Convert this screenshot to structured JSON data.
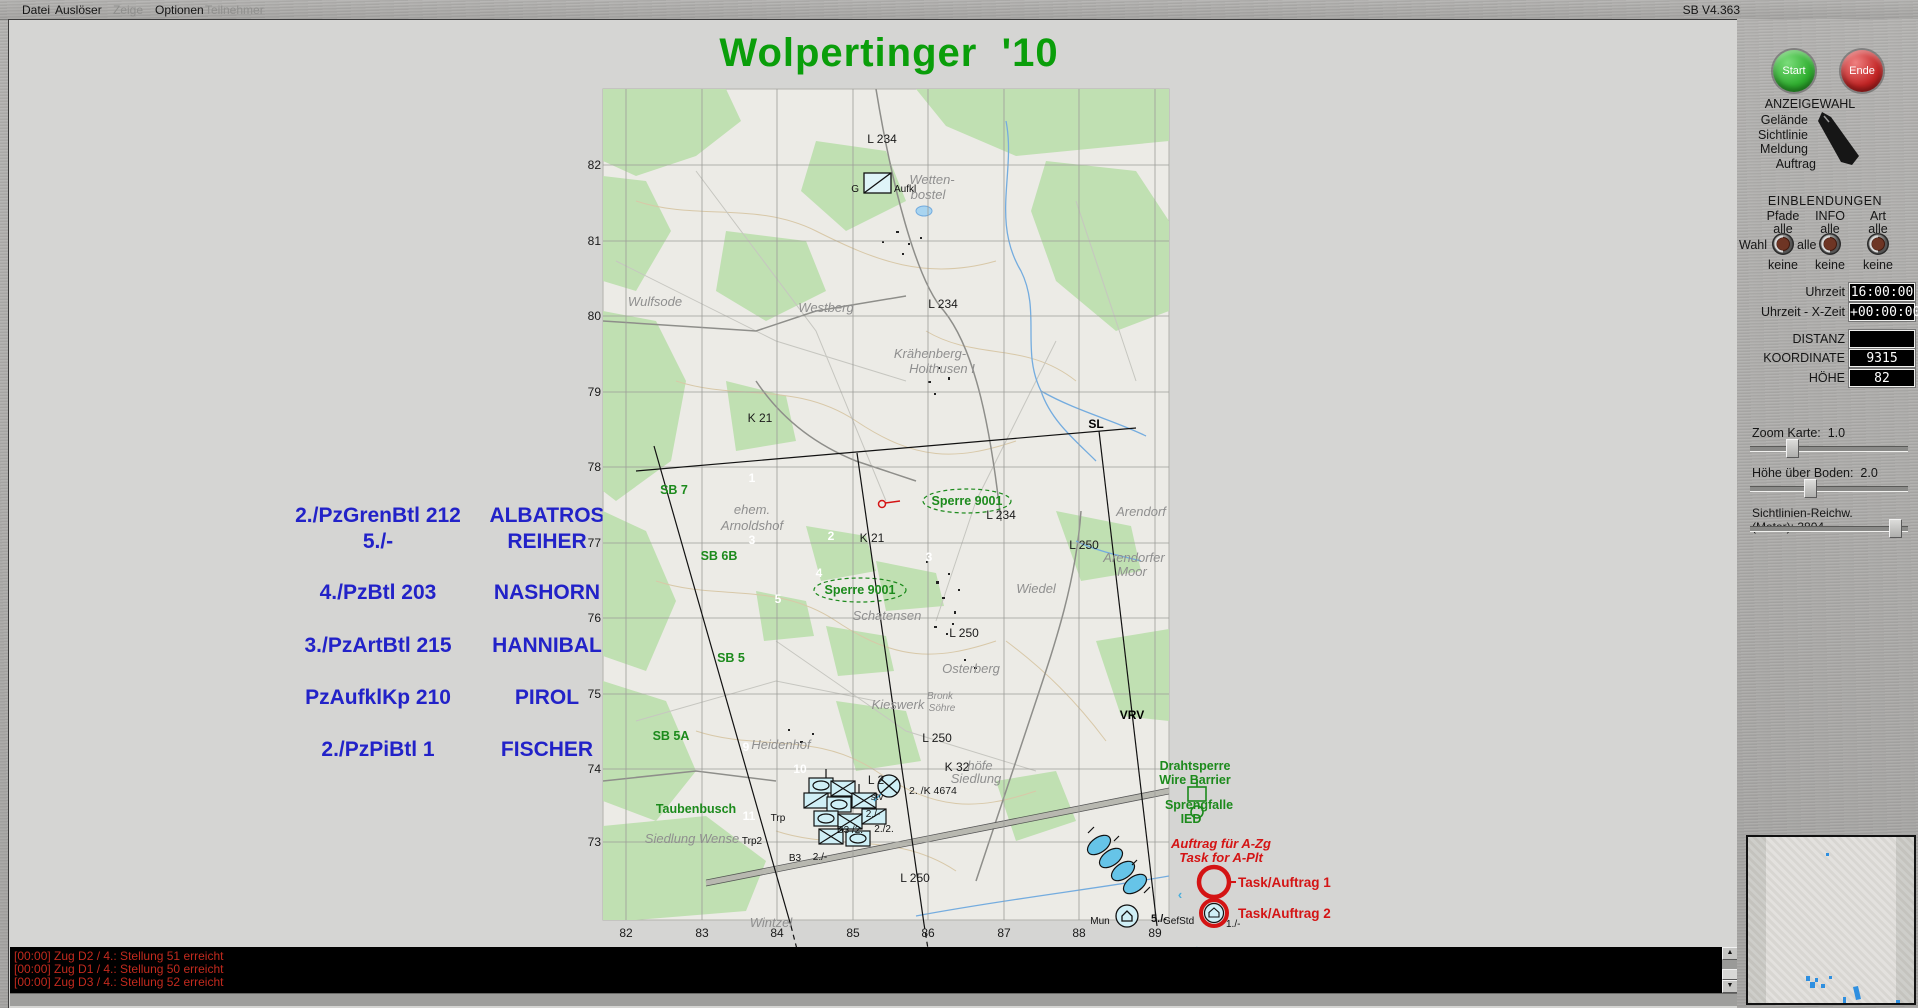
{
  "app": {
    "version": "SB V4.363"
  },
  "menu": {
    "items": [
      {
        "label": "Datei",
        "enabled": true
      },
      {
        "label": "Auslöser",
        "enabled": true
      },
      {
        "label": "Zeige",
        "enabled": false
      },
      {
        "label": "Optionen",
        "enabled": true
      },
      {
        "label": "Teilnehmer",
        "enabled": false
      }
    ]
  },
  "title": "Wolpertinger  '10",
  "roster": {
    "rows": [
      {
        "unit": "2./PzGrenBtl 212",
        "callsign": "ALBATROS"
      },
      {
        "unit": "5./-",
        "callsign": "REIHER"
      },
      {
        "unit": "4./PzBtl 203",
        "callsign": "NASHORN"
      },
      {
        "unit": "3./PzArtBtl 215",
        "callsign": "HANNIBAL"
      },
      {
        "unit": "PzAufklKp 210",
        "callsign": "PIROL"
      },
      {
        "unit": "2./PzPiBtl 1",
        "callsign": "FISCHER"
      }
    ]
  },
  "map": {
    "labels": [
      {
        "t": "82",
        "x": 25,
        "y": 88,
        "c": "grid",
        "a": "e"
      },
      {
        "t": "81",
        "x": 25,
        "y": 164,
        "c": "grid",
        "a": "e"
      },
      {
        "t": "80",
        "x": 25,
        "y": 239,
        "c": "grid",
        "a": "e"
      },
      {
        "t": "79",
        "x": 25,
        "y": 315,
        "c": "grid",
        "a": "e"
      },
      {
        "t": "78",
        "x": 25,
        "y": 390,
        "c": "grid",
        "a": "e"
      },
      {
        "t": "77",
        "x": 25,
        "y": 466,
        "c": "grid",
        "a": "e"
      },
      {
        "t": "76",
        "x": 25,
        "y": 541,
        "c": "grid",
        "a": "e"
      },
      {
        "t": "75",
        "x": 25,
        "y": 617,
        "c": "grid",
        "a": "e"
      },
      {
        "t": "74",
        "x": 25,
        "y": 692,
        "c": "grid",
        "a": "e"
      },
      {
        "t": "73",
        "x": 25,
        "y": 765,
        "c": "grid",
        "a": "e"
      },
      {
        "t": "82",
        "x": 50,
        "y": 856,
        "c": "grid"
      },
      {
        "t": "83",
        "x": 126,
        "y": 856,
        "c": "grid"
      },
      {
        "t": "84",
        "x": 201,
        "y": 856,
        "c": "grid"
      },
      {
        "t": "85",
        "x": 277,
        "y": 856,
        "c": "grid"
      },
      {
        "t": "86",
        "x": 352,
        "y": 856,
        "c": "grid"
      },
      {
        "t": "87",
        "x": 428,
        "y": 856,
        "c": "grid"
      },
      {
        "t": "88",
        "x": 503,
        "y": 856,
        "c": "grid"
      },
      {
        "t": "89",
        "x": 579,
        "y": 856,
        "c": "grid"
      },
      {
        "t": "L 234",
        "x": 306,
        "y": 62,
        "c": "road"
      },
      {
        "t": "L 234",
        "x": 367,
        "y": 227,
        "c": "road"
      },
      {
        "t": "L 234",
        "x": 425,
        "y": 438,
        "c": "road"
      },
      {
        "t": "K 21",
        "x": 184,
        "y": 341,
        "c": "road"
      },
      {
        "t": "K 21",
        "x": 296,
        "y": 461,
        "c": "road"
      },
      {
        "t": "L 250",
        "x": 508,
        "y": 468,
        "c": "road"
      },
      {
        "t": "L 250",
        "x": 388,
        "y": 556,
        "c": "road"
      },
      {
        "t": "L 250",
        "x": 361,
        "y": 661,
        "c": "road"
      },
      {
        "t": "L 250",
        "x": 339,
        "y": 801,
        "c": "road"
      },
      {
        "t": "K 32",
        "x": 381,
        "y": 690,
        "c": "road"
      },
      {
        "t": "L 2",
        "x": 300,
        "y": 703,
        "c": "road"
      },
      {
        "t": "2. /K 4674",
        "x": 333,
        "y": 713,
        "c": "roadsm",
        "a": "s"
      },
      {
        "t": "Wulfsode",
        "x": 79,
        "y": 225,
        "c": "place"
      },
      {
        "t": "Westberg",
        "x": 250,
        "y": 231,
        "c": "place"
      },
      {
        "t": "Krähenberg-",
        "x": 354,
        "y": 277,
        "c": "place"
      },
      {
        "t": "Holthusen I",
        "x": 366,
        "y": 292,
        "c": "place"
      },
      {
        "t": "Wetten-",
        "x": 356,
        "y": 103,
        "c": "place"
      },
      {
        "t": "bostel",
        "x": 352,
        "y": 118,
        "c": "place"
      },
      {
        "t": "ehem.",
        "x": 176,
        "y": 433,
        "c": "place"
      },
      {
        "t": "Arnoldshof",
        "x": 176,
        "y": 449,
        "c": "place"
      },
      {
        "t": "Arendorf",
        "x": 565,
        "y": 435,
        "c": "place"
      },
      {
        "t": "Arendorfer",
        "x": 558,
        "y": 481,
        "c": "place"
      },
      {
        "t": "Moor",
        "x": 556,
        "y": 495,
        "c": "place"
      },
      {
        "t": "Wiedel",
        "x": 460,
        "y": 512,
        "c": "place"
      },
      {
        "t": "Osterberg",
        "x": 395,
        "y": 592,
        "c": "place"
      },
      {
        "t": "Kieswerk",
        "x": 322,
        "y": 628,
        "c": "place"
      },
      {
        "t": "Bronk",
        "x": 364,
        "y": 618,
        "c": "placesm"
      },
      {
        "t": "Söhre",
        "x": 366,
        "y": 630,
        "c": "placesm"
      },
      {
        "t": "Schatensen",
        "x": 311,
        "y": 539,
        "c": "place"
      },
      {
        "t": "Heidenhof",
        "x": 205,
        "y": 668,
        "c": "place"
      },
      {
        "t": "Siedlung Wense",
        "x": 116,
        "y": 762,
        "c": "place"
      },
      {
        "t": "Wintzel",
        "x": 195,
        "y": 846,
        "c": "place"
      },
      {
        "t": "höfe",
        "x": 404,
        "y": 689,
        "c": "place"
      },
      {
        "t": "Siedlung",
        "x": 400,
        "y": 702,
        "c": "place"
      },
      {
        "t": "SB 7",
        "x": 98,
        "y": 413,
        "c": "green"
      },
      {
        "t": "SB 6B",
        "x": 143,
        "y": 479,
        "c": "green"
      },
      {
        "t": "SB 5",
        "x": 155,
        "y": 581,
        "c": "green"
      },
      {
        "t": "SB 5A",
        "x": 95,
        "y": 659,
        "c": "green"
      },
      {
        "t": "Sperre 9001",
        "x": 391,
        "y": 424,
        "c": "green"
      },
      {
        "t": "Sperre 9001",
        "x": 284,
        "y": 513,
        "c": "green"
      },
      {
        "t": "Taubenbusch",
        "x": 120,
        "y": 732,
        "c": "green"
      },
      {
        "t": "1",
        "x": 176,
        "y": 401,
        "c": "white"
      },
      {
        "t": "3",
        "x": 176,
        "y": 463,
        "c": "white"
      },
      {
        "t": "2",
        "x": 255,
        "y": 459,
        "c": "white"
      },
      {
        "t": "4",
        "x": 243,
        "y": 496,
        "c": "white"
      },
      {
        "t": "5",
        "x": 202,
        "y": 522,
        "c": "white"
      },
      {
        "t": "3",
        "x": 353,
        "y": 480,
        "c": "white"
      },
      {
        "t": "9",
        "x": 170,
        "y": 670,
        "c": "white"
      },
      {
        "t": "10",
        "x": 224,
        "y": 692,
        "c": "white"
      },
      {
        "t": "11",
        "x": 173,
        "y": 739,
        "c": "white"
      },
      {
        "t": "SL",
        "x": 520,
        "y": 347,
        "c": "phase"
      },
      {
        "t": "VRV",
        "x": 556,
        "y": 638,
        "c": "phase"
      },
      {
        "t": "Trp",
        "x": 202,
        "y": 740,
        "c": "tiny"
      },
      {
        "t": "Trp2",
        "x": 176,
        "y": 763,
        "c": "tiny"
      },
      {
        "t": "B3",
        "x": 219,
        "y": 780,
        "c": "tiny"
      },
      {
        "t": "2./-",
        "x": 244,
        "y": 779,
        "c": "tiny"
      },
      {
        "t": "B3 /2.",
        "x": 274,
        "y": 752,
        "c": "tiny"
      },
      {
        "t": "2./2.",
        "x": 308,
        "y": 751,
        "c": "tiny"
      },
      {
        "t": "2./-",
        "x": 297,
        "y": 736,
        "c": "tiny"
      },
      {
        "t": "stv",
        "x": 301,
        "y": 719,
        "c": "tiny"
      },
      {
        "t": "G",
        "x": 283,
        "y": 111,
        "c": "tiny",
        "a": "e"
      },
      {
        "t": "Aufkl",
        "x": 318,
        "y": 111,
        "c": "tiny",
        "a": "s"
      },
      {
        "t": "Mun",
        "x": 524,
        "y": 843,
        "c": "tiny"
      },
      {
        "t": "5./-",
        "x": 583,
        "y": 841,
        "c": "tinyb"
      },
      {
        "t": "GefStd",
        "x": 587,
        "y": 843,
        "c": "tiny",
        "a": "s"
      },
      {
        "t": "1./-",
        "x": 650,
        "y": 846,
        "c": "tiny",
        "a": "s"
      },
      {
        "t": "Drahtsperre",
        "x": 619,
        "y": 689,
        "c": "green"
      },
      {
        "t": "Wire Barrier",
        "x": 619,
        "y": 703,
        "c": "green"
      },
      {
        "t": "Sprengfalle",
        "x": 623,
        "y": 728,
        "c": "green"
      },
      {
        "t": "IED",
        "x": 615,
        "y": 742,
        "c": "green"
      },
      {
        "t": "Auftrag für A-Zg",
        "x": 645,
        "y": 767,
        "c": "redi"
      },
      {
        "t": "Task for A-Plt",
        "x": 645,
        "y": 781,
        "c": "redi"
      },
      {
        "t": "Task/Auftrag 1",
        "x": 662,
        "y": 806,
        "c": "redb",
        "a": "s"
      },
      {
        "t": "Task/Auftrag 2",
        "x": 662,
        "y": 837,
        "c": "redb",
        "a": "s"
      },
      {
        "t": "‹",
        "x": 604,
        "y": 818,
        "c": "cyan"
      },
      {
        "t": "‹",
        "x": 620,
        "y": 872,
        "c": "cyan"
      }
    ]
  },
  "messages": [
    "[00:00] Zug D2 / 4.: Stellung 51 erreicht",
    "[00:00] Zug D1 / 4.: Stellung 50 erreicht",
    "[00:00] Zug D3 / 4.: Stellung 52 erreicht"
  ],
  "panel": {
    "start_label": "Start",
    "ende_label": "Ende",
    "anzeigewahl": {
      "title": "ANZEIGEWAHL",
      "items": [
        "Gelände",
        "Sichtlinie",
        "Meldung",
        "Auftrag"
      ]
    },
    "einblendungen": {
      "title": "EINBLENDUNGEN",
      "wahl_label": "Wahl",
      "alle_mid_label": "alle",
      "columns": [
        {
          "name": "Pfade",
          "top": "alle",
          "bottom": "keine"
        },
        {
          "name": "INFO",
          "top": "alle",
          "bottom": "keine"
        },
        {
          "name": "Art",
          "top": "alle",
          "bottom": "keine"
        }
      ]
    },
    "readouts": [
      {
        "label": "Uhrzeit",
        "value": "16:00:00"
      },
      {
        "label": "Uhrzeit - X-Zeit",
        "value": "+00:00:00"
      },
      {
        "label": "DISTANZ",
        "value": ""
      },
      {
        "label": "KOORDINATE",
        "value": "9315 7482"
      },
      {
        "label": "HÖHE",
        "value": "82"
      }
    ],
    "sliders": [
      {
        "label": "Zoom Karte:",
        "value": "1.0",
        "pos": 25
      },
      {
        "label": "Höhe über Boden:",
        "value": "2.0",
        "pos": 37
      },
      {
        "label": "Sichtlinien-Reichw. (Meter):",
        "value": "3804",
        "pos": 96
      }
    ]
  },
  "colors": {
    "title_green": "#0a9e0a",
    "roster_blue": "#2222c8",
    "message_red": "#c22a1e",
    "task_red": "#d41414",
    "map_green_label": "#1c8a1c",
    "unit_cyan": "#cfeff6"
  }
}
